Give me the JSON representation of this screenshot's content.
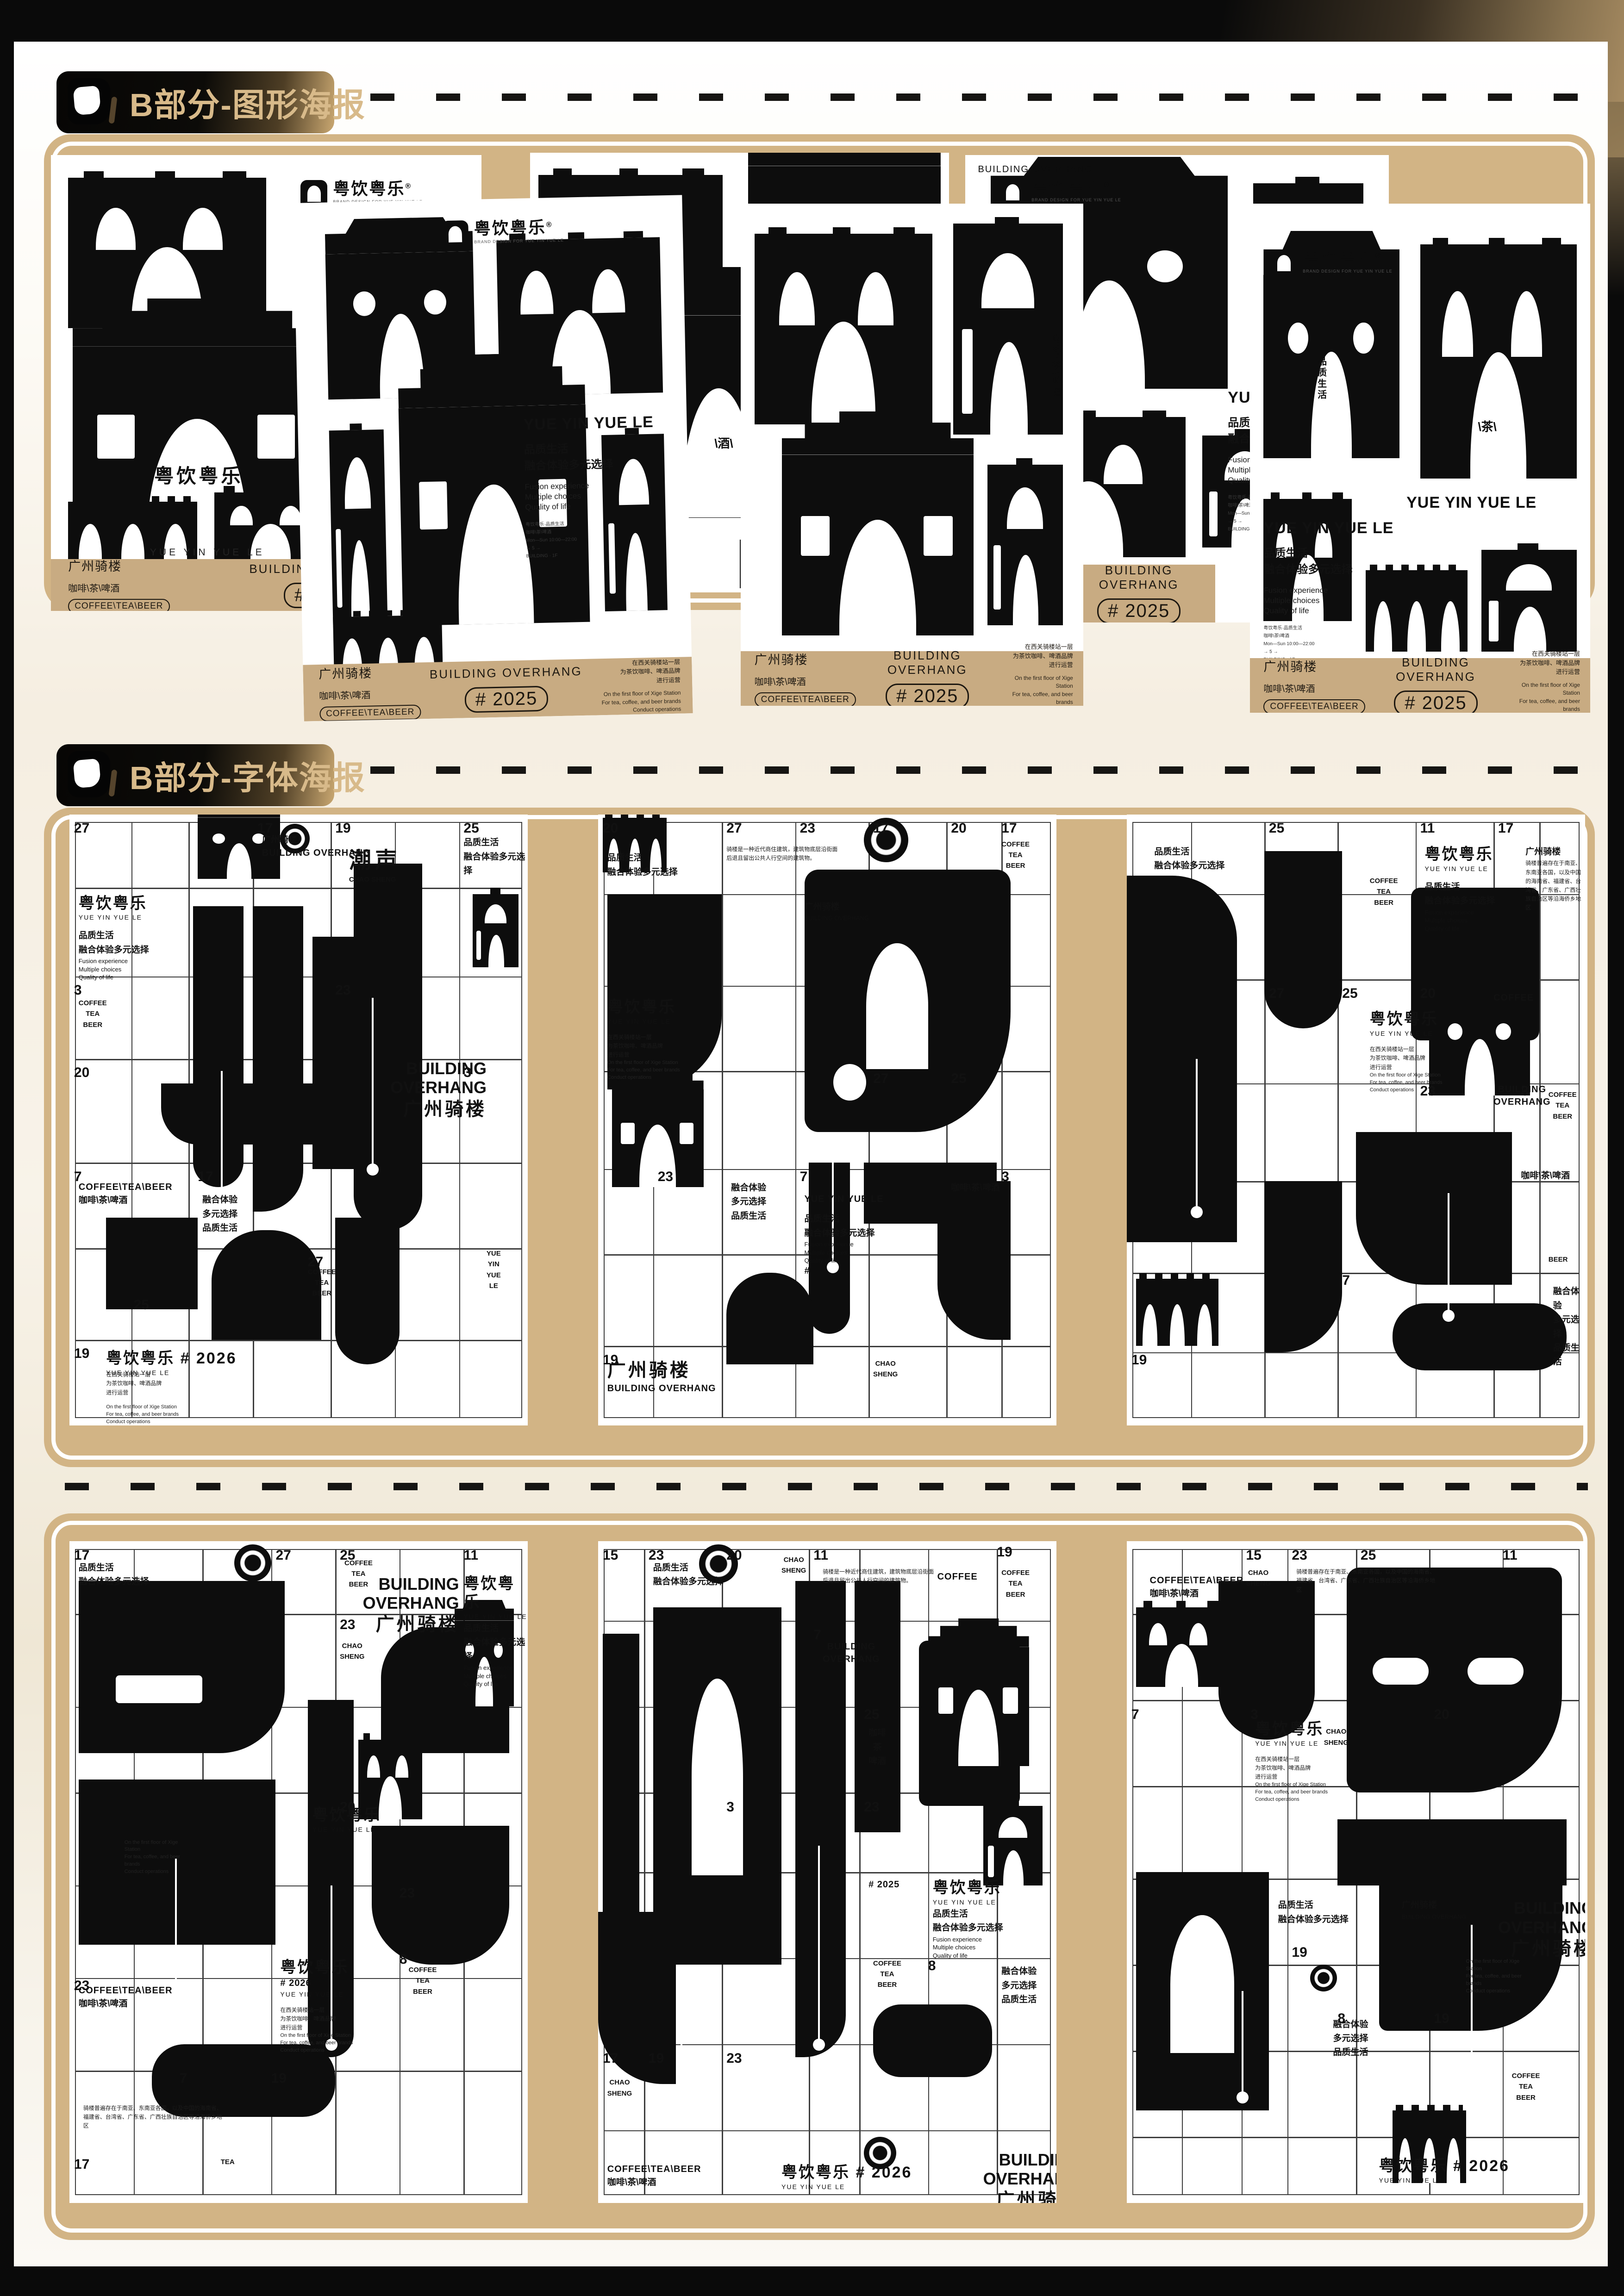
{
  "page": {
    "frame_color": "#0a0a0a",
    "gold": "#d2b485",
    "footer_tan": "#c8ab82",
    "accent_text": "#d8ba8a",
    "grid_line": "#3d3d3d"
  },
  "sections": [
    {
      "title": "B部分-图形海报"
    },
    {
      "title": "B部分-字体海报"
    }
  ],
  "brand": {
    "logo_cn": "粤饮粤乐",
    "logo_reg": "®",
    "logo_tagline": "BRAND DESIGN FOR YUE YIN YUE LE",
    "name_en": "YUE YIN YUE LE",
    "slogan_cn": [
      "品质生活",
      "融合体验多元选择"
    ],
    "slogan_en": [
      "Fusion experience",
      "Multiple choices",
      "Quality of life"
    ],
    "fine_print": [
      "粤饮粤乐·品质生活",
      "咖啡\\茶\\啤酒",
      "Mon—Sun 10:00—22:00",
      "→ 5 →",
      "BUILDING · 1F"
    ]
  },
  "graphic_footer": {
    "title_cn": "广州骑楼",
    "drinks_cn": "咖啡\\茶\\啤酒",
    "drinks_pill": "COFFEE\\TEA\\BEER",
    "building_en": "BUILDING OVERHANG",
    "year_pill": "# 2025",
    "right_cn": [
      "在西关骑楼站一层",
      "为茶饮咖啡、啤酒品牌",
      "进行运营"
    ],
    "right_en": [
      "On the first floor of Xige Station",
      "For tea, coffee, and beer brands",
      "Conduct operations"
    ]
  },
  "phrases": {
    "brand_cn": "粤饮粤乐",
    "brand_en": "YUE YIN YUE LE",
    "chao_cn": "潮声",
    "chao_en": "CHAO SHENG",
    "q1": "品质生活",
    "q2": "融合体验多元选择",
    "fuse3": [
      "融合体验",
      "多元选择",
      "品质生活"
    ],
    "en3": [
      "Fusion experience",
      "Multiple choices",
      "Quality of life"
    ],
    "coffee_stack": [
      "COFFEE",
      "TEA",
      "BEER"
    ],
    "coffee_slash": "COFFEE\\TEA\\BEER",
    "drinks_cn": "咖啡\\茶\\啤酒",
    "gz_cn": "广州骑楼",
    "gz_en": "BUILDING OVERHANG",
    "tea_slash": "\\茶\\",
    "jiu_slash": "\\酒\\",
    "coffee": "COFFEE",
    "tea": "TEA",
    "beer": "BEER",
    "year": "# 2025",
    "year2": "# 2026",
    "hash": "#",
    "loc_cn": [
      "在西关骑楼站一层",
      "为茶饮咖啡、啤酒品牌",
      "进行运营"
    ],
    "loc_en": [
      "On the first floor of Xige Station",
      "For tea, coffee, and beer brands",
      "Conduct operations"
    ],
    "intro_cn": "骑楼是一种近代商住建筑，建筑物底层沿街面后退且留出公共人行空间的建筑物。",
    "origin_cn": "骑楼普遍存在于南亚、东南亚各国，以及中国的海南省、福建省、台湾省、广东省、广西壮族自治区等沿海侨乡地区"
  },
  "graphic_posters": [
    {
      "name": "graphic-poster-1",
      "captions": [
        "brand_arch",
        "yyl_cap"
      ]
    },
    {
      "name": "graphic-poster-2",
      "captions": [
        "bo_vert",
        "jiu_arch"
      ]
    },
    {
      "name": "graphic-poster-3",
      "captions": [
        "bo_head"
      ]
    },
    {
      "name": "graphic-poster-4",
      "captions": []
    },
    {
      "name": "graphic-poster-5",
      "captions": [
        "drinks_vert"
      ]
    },
    {
      "name": "graphic-poster-6",
      "captions": [
        "q1_vert",
        "tea_arch",
        "yyl_head"
      ]
    }
  ],
  "type_posters": [
    {
      "name": "type-poster-1",
      "cells": [
        "27",
        "17",
        "19",
        "25",
        "3",
        "23",
        "20",
        "7",
        "17",
        "27",
        "19",
        "25",
        "3"
      ],
      "texts": [
        "brand_block",
        "gz_head",
        "chao",
        "q12",
        "coffee_stack",
        "bo_big",
        "coffee_slash2",
        "fuse3",
        "coffee_stack",
        "brand_year2",
        "loc_block",
        "yyl_vert"
      ]
    },
    {
      "name": "type-poster-2",
      "cells": [
        "20",
        "27",
        "17",
        "23",
        "20",
        "17",
        "7",
        "19",
        "23",
        "27",
        "25",
        "3"
      ],
      "texts": [
        "q12",
        "intro",
        "gz_small",
        "coffee_stack",
        "brand_loc",
        "fuse3",
        "yyl_q_en",
        "gz_big",
        "chao_stack",
        "drinks_line"
      ]
    },
    {
      "name": "type-poster-3",
      "cells": [
        "25",
        "27",
        "25",
        "20",
        "3",
        "7",
        "11",
        "17",
        "23",
        "19"
      ],
      "texts": [
        "q12",
        "coffee_stack",
        "brand_block",
        "gz_origin",
        "brand_loc",
        "coffee_line",
        "bo_mid",
        "coffee_stack",
        "drinks_line",
        "beer_line",
        "fuse3"
      ]
    },
    {
      "name": "type-poster-4",
      "cells": [
        "17",
        "27",
        "23",
        "25",
        "11",
        "20",
        "23",
        "8",
        "19",
        "7",
        "23",
        "17"
      ],
      "texts": [
        "q12",
        "coffee_stack",
        "bo_big",
        "chao_stack",
        "brand_q_en",
        "loc_en",
        "brand_small",
        "coffee_stack",
        "yyl_year",
        "origin",
        "tea_line",
        "coffee_slash2"
      ]
    },
    {
      "name": "type-poster-5",
      "cells": [
        "15",
        "23",
        "20",
        "11",
        "19",
        "7",
        "25",
        "3",
        "23",
        "8",
        "17",
        "19",
        "23"
      ],
      "texts": [
        "q12",
        "chao_stack",
        "intro",
        "coffee_line",
        "coffee_stack",
        "bo_mid",
        "drinks_vert3",
        "year_line",
        "brand_q_en",
        "coffee_stack",
        "fuse3",
        "chao_stack",
        "coffee_slash2",
        "brand_year2",
        "bo_big"
      ]
    },
    {
      "name": "type-poster-6",
      "cells": [
        "15",
        "23",
        "3",
        "19",
        "8",
        "19",
        "25",
        "7",
        "20",
        "11"
      ],
      "texts": [
        "coffee_slash2",
        "chao_stack",
        "origin",
        "brand_loc",
        "chao_stack",
        "q12",
        "loc_en",
        "gz_small",
        "bo_big",
        "coffee_stack",
        "fuse3",
        "brand_year2"
      ]
    }
  ]
}
